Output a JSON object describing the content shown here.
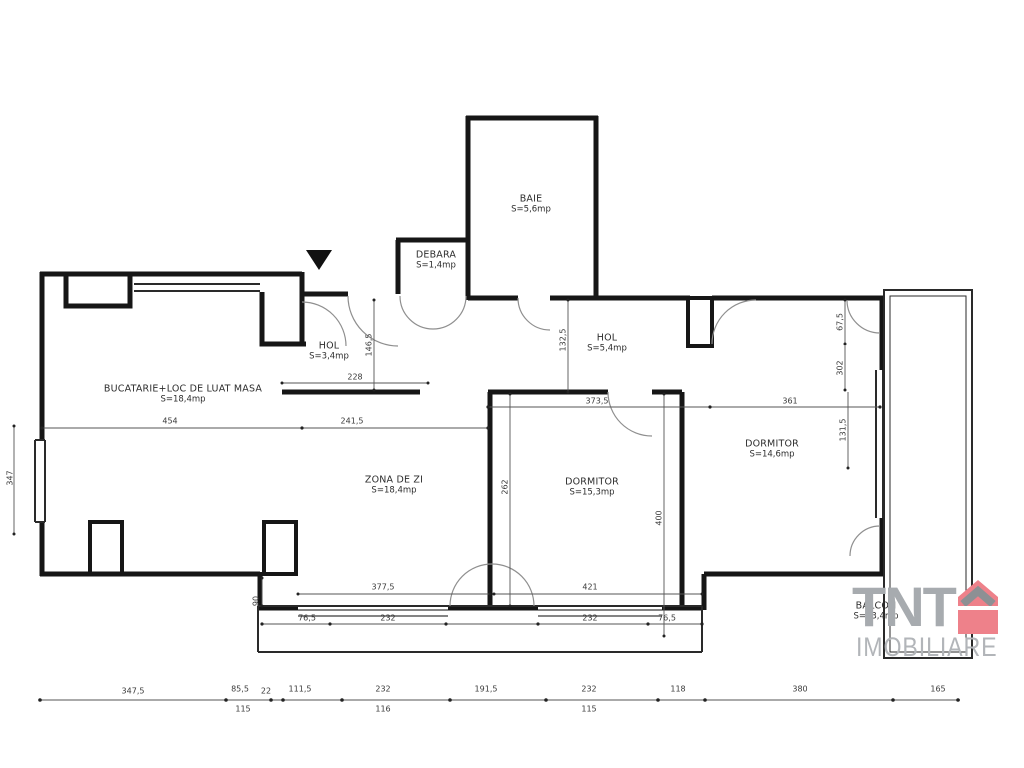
{
  "brand": {
    "name": "TNT",
    "subtitle": "IMOBILIARE"
  },
  "rooms": {
    "baie": {
      "name": "BAIE",
      "area": "S=5,6mp"
    },
    "debara": {
      "name": "DEBARA",
      "area": "S=1,4mp"
    },
    "hol_left": {
      "name": "HOL",
      "area": "S=3,4mp"
    },
    "bucatarie": {
      "name": "BUCATARIE+LOC DE LUAT MASA",
      "area": "S=18,4mp"
    },
    "zona_de_zi": {
      "name": "ZONA DE ZI",
      "area": "S=18,4mp"
    },
    "hol_right": {
      "name": "HOL",
      "area": "S=5,4mp"
    },
    "dormitor_mid": {
      "name": "DORMITOR",
      "area": "S=15,3mp"
    },
    "dormitor_right": {
      "name": "DORMITOR",
      "area": "S=14,6mp"
    },
    "balcon": {
      "name": "BALCON",
      "area": "S=13,4mp"
    }
  },
  "dims": {
    "d454": "454",
    "d241_5": "241,5",
    "d228": "228",
    "d146_5": "146,5",
    "d132_5": "132,5",
    "d373_5": "373,5",
    "d361": "361",
    "d67_5": "67,5",
    "d302": "302",
    "d131_5": "131,5",
    "d262": "262",
    "d400": "400",
    "d377_5": "377,5",
    "d421": "421",
    "d76_5a": "76,5",
    "d232a": "232",
    "d232b": "232",
    "d76_5b": "76,5",
    "d90": "90",
    "d347": "347"
  },
  "bottom_dims": {
    "row1": [
      "347,5",
      "85,5",
      "22",
      "111,5",
      "232",
      "191,5",
      "232",
      "118",
      "380",
      "165"
    ],
    "row2": [
      "115",
      "116",
      "115"
    ]
  }
}
